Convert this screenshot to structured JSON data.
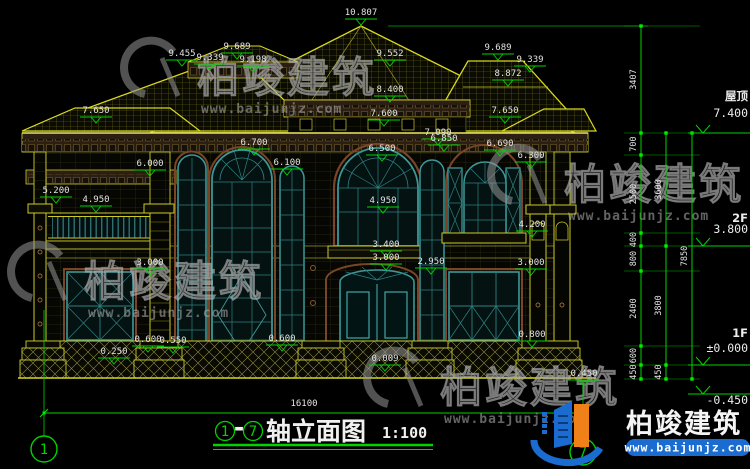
{
  "drawing": {
    "axis_from": "1",
    "axis_to": "7",
    "dash": "-",
    "title": "轴立面图",
    "scale": "1:100",
    "overall_width_mm": "16100"
  },
  "colors": {
    "line_yellow": "#cfcf1e",
    "dim_green": "#00d400",
    "glass_teal": "#3c9898",
    "trim_brown": "#7a4526",
    "text_white": "#e3e3e3",
    "logo_blue": "#1a6cd0",
    "logo_orange": "#f08018",
    "watermark_gray": "#9a9a9a"
  },
  "watermark": {
    "brand": "柏竣建筑",
    "url": "www.baijunjz.com"
  },
  "logo": {
    "brand": "柏竣建筑",
    "url": "www.baijunjz.com"
  },
  "watermark_positions": [
    {
      "x": 165,
      "y": 78
    },
    {
      "x": 532,
      "y": 185
    },
    {
      "x": 52,
      "y": 282
    },
    {
      "x": 408,
      "y": 388
    }
  ],
  "axis_bubbles": [
    {
      "label": "1",
      "x": 44,
      "y": 449,
      "line_top": 310
    },
    {
      "label": "7",
      "x": 583,
      "y": 452,
      "line_top": 380
    }
  ],
  "levels": [
    {
      "name": "屋顶",
      "elev": "7.400",
      "y": 133,
      "ndy": -33,
      "edy": -16
    },
    {
      "name": "2F",
      "elev": "3.800",
      "y": 246,
      "ndy": -24,
      "edy": -13
    },
    {
      "name": "1F",
      "elev": "±0.000",
      "y": 365,
      "ndy": -28,
      "edy": -13
    },
    {
      "name": "",
      "elev": "-0.450",
      "y": 394,
      "ndy": 0,
      "edy": 10
    }
  ],
  "dim_chains": [
    {
      "x": 641,
      "ys": [
        26,
        133,
        155,
        233,
        246,
        271,
        346,
        365,
        379
      ],
      "labels": [
        "3407",
        "700",
        "2500",
        "400",
        "800",
        "2400",
        "600",
        "450"
      ]
    },
    {
      "x": 666,
      "ys": [
        133,
        246,
        365,
        379
      ],
      "labels": [
        "3600",
        "3800",
        "450"
      ]
    },
    {
      "x": 692,
      "ys": [
        133,
        379
      ],
      "labels": [
        "7850"
      ]
    }
  ],
  "elevation_marks": [
    {
      "t": "10.807",
      "x": 361,
      "y": 12
    },
    {
      "t": "9.455",
      "x": 182,
      "y": 53
    },
    {
      "t": "9.689",
      "x": 237,
      "y": 46
    },
    {
      "t": "9.339",
      "x": 210,
      "y": 57
    },
    {
      "t": "9.198",
      "x": 253,
      "y": 59
    },
    {
      "t": "9.552",
      "x": 390,
      "y": 53
    },
    {
      "t": "8.400",
      "x": 390,
      "y": 89
    },
    {
      "t": "9.689",
      "x": 498,
      "y": 47
    },
    {
      "t": "9.339",
      "x": 530,
      "y": 59
    },
    {
      "t": "8.872",
      "x": 508,
      "y": 73
    },
    {
      "t": "7.650",
      "x": 96,
      "y": 110
    },
    {
      "t": "7.650",
      "x": 505,
      "y": 110
    },
    {
      "t": "7.600",
      "x": 384,
      "y": 113
    },
    {
      "t": "7.090",
      "x": 438,
      "y": 132
    },
    {
      "t": "6.850",
      "x": 444,
      "y": 138
    },
    {
      "t": "6.700",
      "x": 254,
      "y": 142
    },
    {
      "t": "6.690",
      "x": 500,
      "y": 143
    },
    {
      "t": "6.500",
      "x": 382,
      "y": 148
    },
    {
      "t": "6.300",
      "x": 531,
      "y": 155
    },
    {
      "t": "6.000",
      "x": 150,
      "y": 163
    },
    {
      "t": "6.100",
      "x": 287,
      "y": 162
    },
    {
      "t": "5.200",
      "x": 56,
      "y": 190
    },
    {
      "t": "4.950",
      "x": 96,
      "y": 199
    },
    {
      "t": "4.950",
      "x": 383,
      "y": 200
    },
    {
      "t": "4.200",
      "x": 532,
      "y": 224
    },
    {
      "t": "3.400",
      "x": 386,
      "y": 244
    },
    {
      "t": "3.000",
      "x": 386,
      "y": 257
    },
    {
      "t": "2.950",
      "x": 431,
      "y": 261
    },
    {
      "t": "3.000",
      "x": 150,
      "y": 262
    },
    {
      "t": "3.000",
      "x": 531,
      "y": 262
    },
    {
      "t": "0.800",
      "x": 532,
      "y": 334
    },
    {
      "t": "0.600",
      "x": 148,
      "y": 339
    },
    {
      "t": "0.550",
      "x": 173,
      "y": 340
    },
    {
      "t": "0.250",
      "x": 114,
      "y": 351
    },
    {
      "t": "0.600",
      "x": 282,
      "y": 338
    },
    {
      "t": "0.009",
      "x": 385,
      "y": 358
    },
    {
      "t": "0.450",
      "x": 584,
      "y": 373
    }
  ],
  "bottom_dim": {
    "label": "16100",
    "y": 413,
    "x1": 44,
    "x2": 583,
    "tx": 304,
    "ty": 406
  }
}
